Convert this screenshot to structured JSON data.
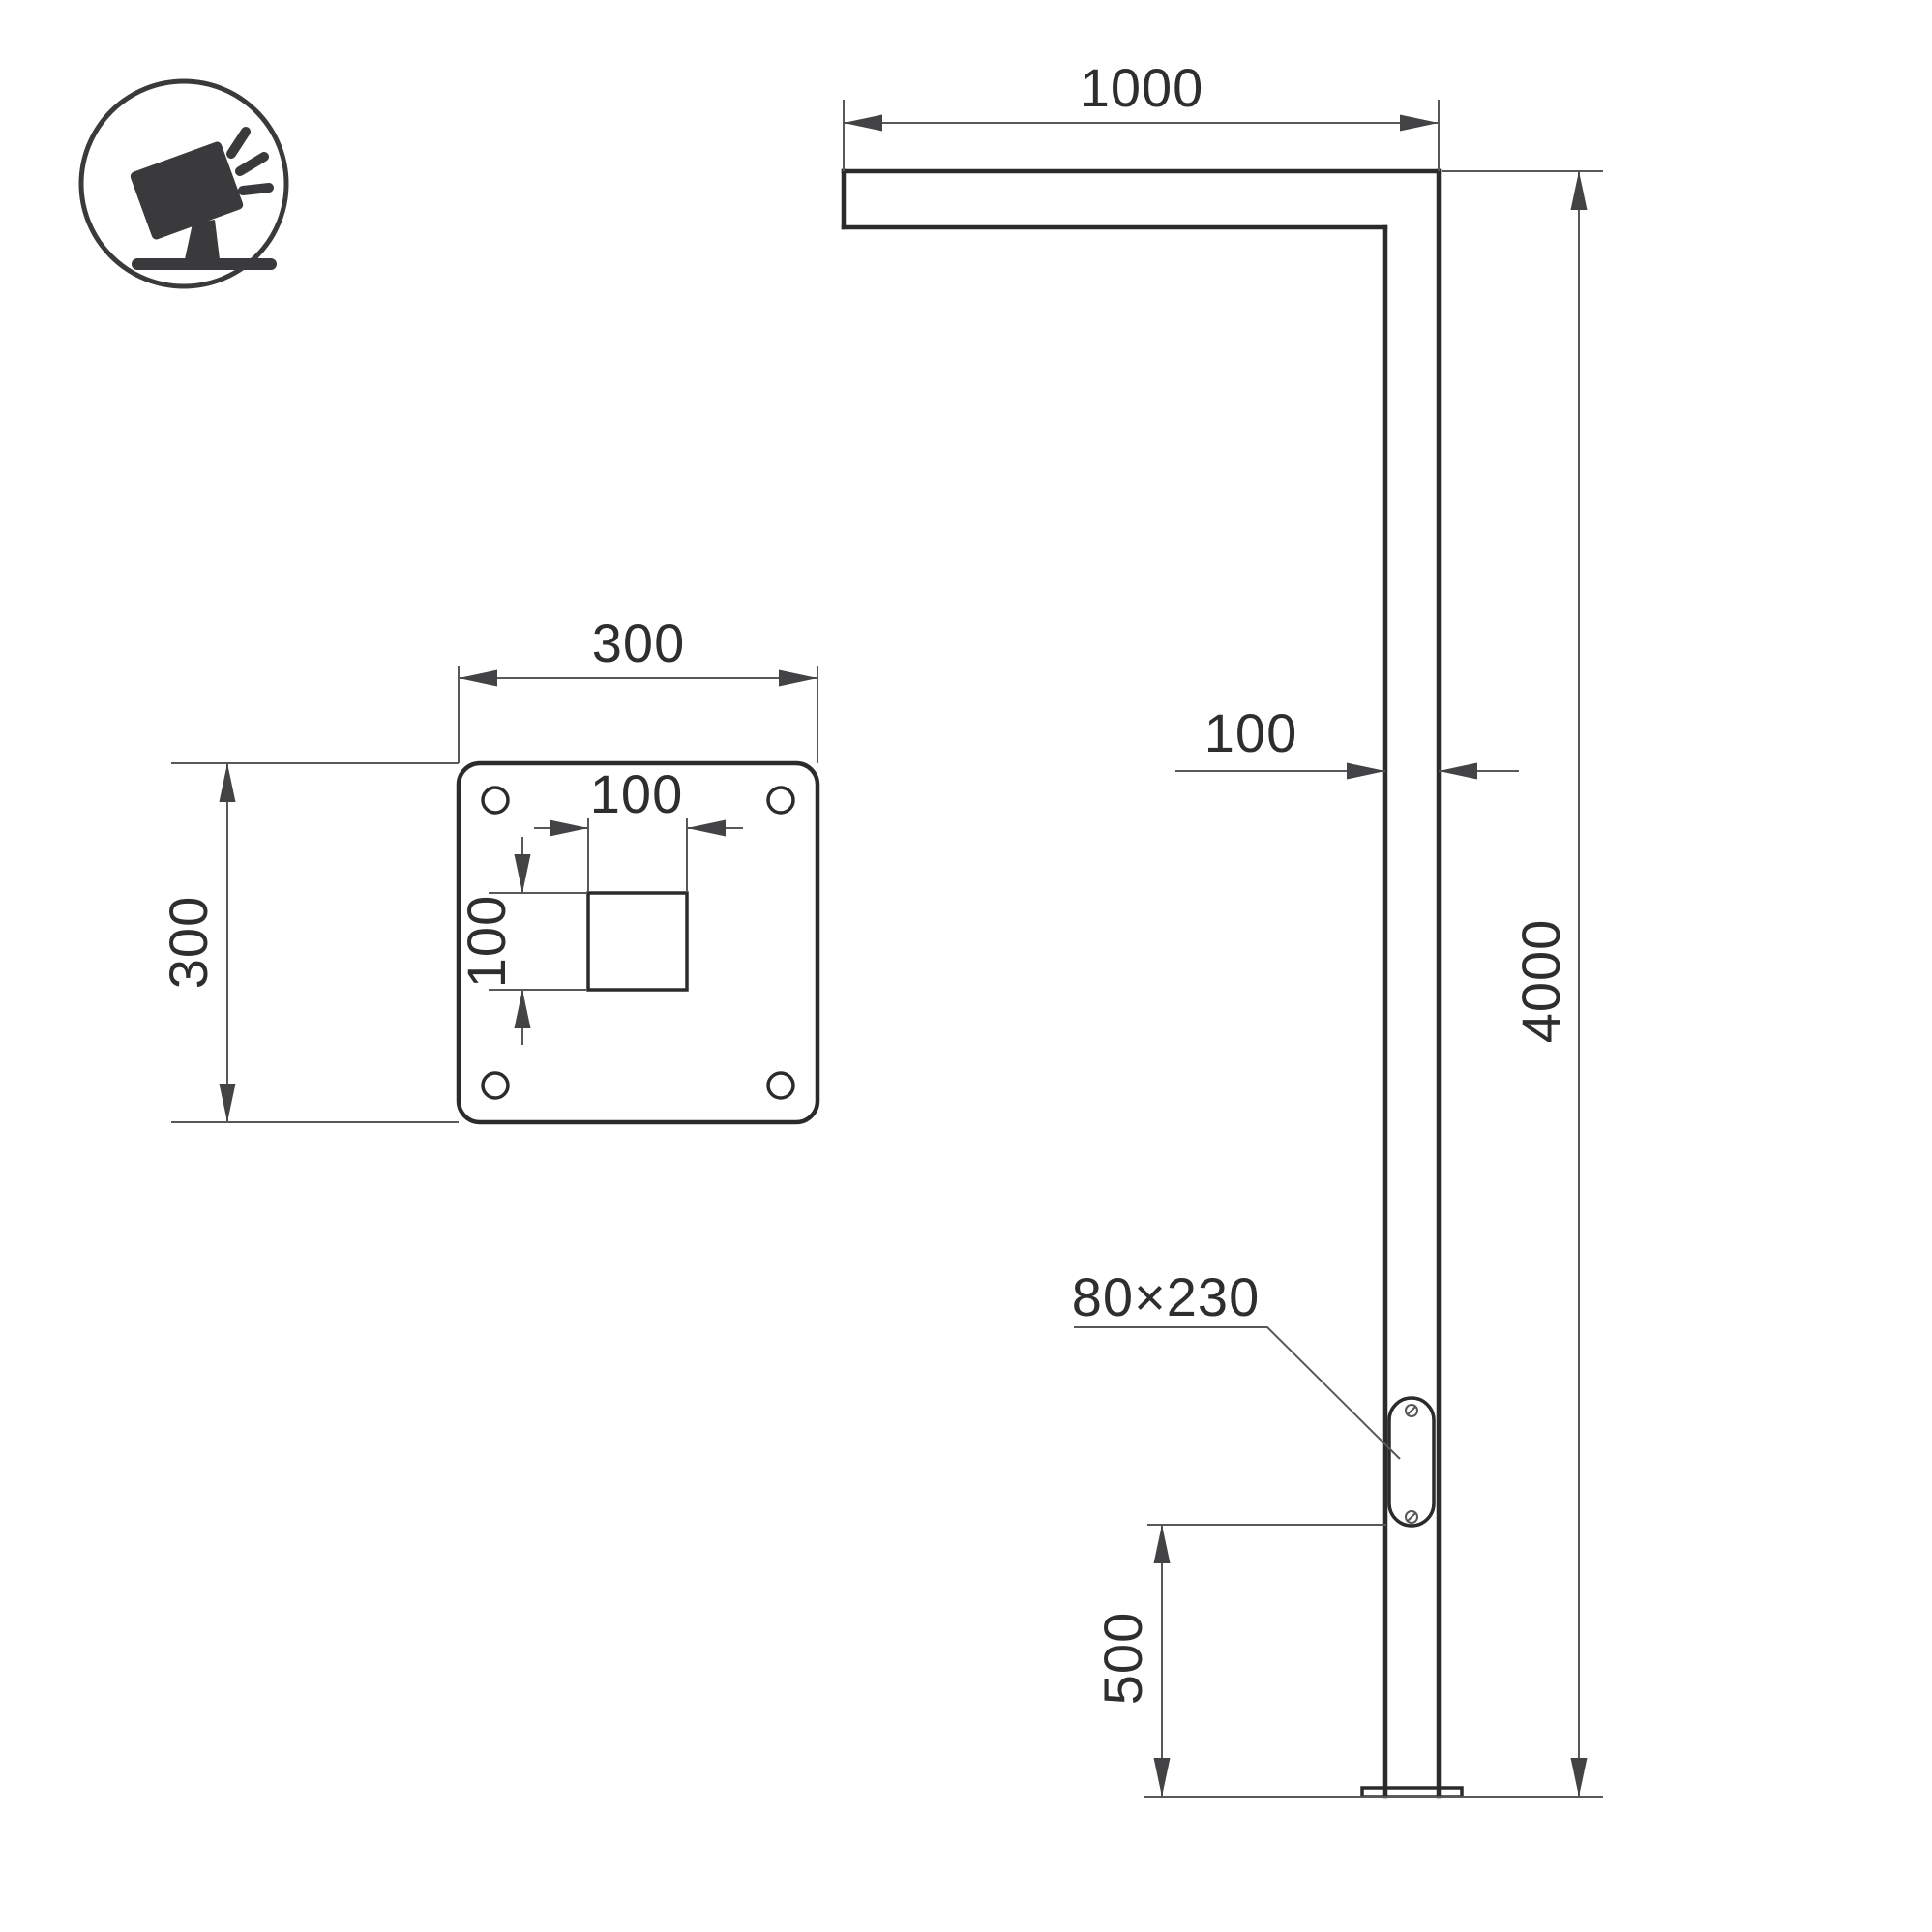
{
  "drawing": {
    "type": "technical-drawing",
    "subject": "Street light pole — front view with mounting flange detail",
    "colors": {
      "background": "#ffffff",
      "line": "#2b2b2d",
      "thin": "#58585a",
      "arrow": "#434345",
      "text": "#2e2e30",
      "icon": "#3a3a3c"
    },
    "labels": {
      "arm_length": "1000",
      "pole_width": "100",
      "pole_height": "4000",
      "door_size": "80×230",
      "door_height": "500",
      "plate_width": "300",
      "plate_height": "300",
      "hole_width": "100",
      "hole_height": "100"
    },
    "icon": {
      "name": "tilted-floodlight-on-stand"
    }
  }
}
